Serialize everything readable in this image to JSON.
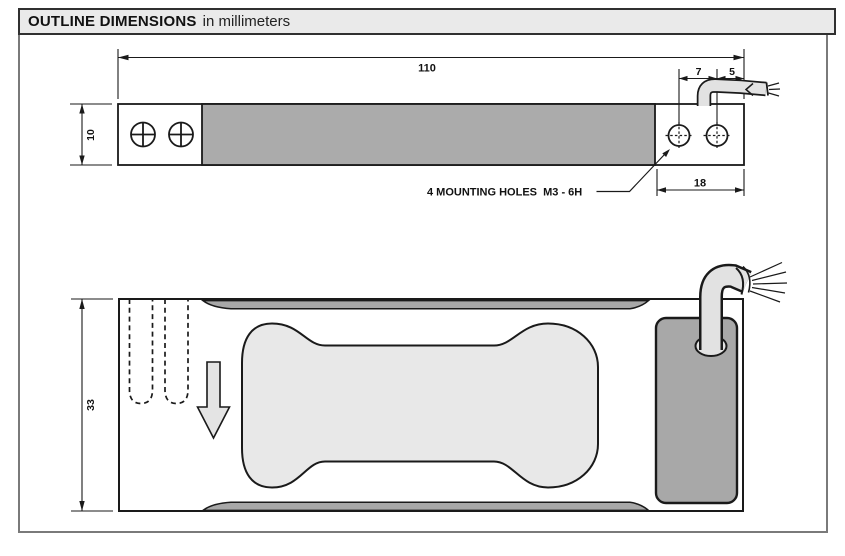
{
  "header": {
    "title": "OUTLINE DIMENSIONS",
    "subtitle": "in millimeters"
  },
  "top_view": {
    "dim_overall_length": "110",
    "dim_height": "10",
    "dim_hole_spacing": "7",
    "dim_hole_to_end": "5",
    "dim_mount_section": "18",
    "note_mounting_holes": "4 MOUNTING HOLES  M3 - 6H"
  },
  "bottom_view": {
    "dim_width": "33"
  },
  "colors": {
    "line": "#1a1a1a",
    "metal_gray": "#ababab",
    "light_gray": "#e6e6e6",
    "header_bg": "#eaeaea",
    "frame_border": "#7a7a7a"
  }
}
